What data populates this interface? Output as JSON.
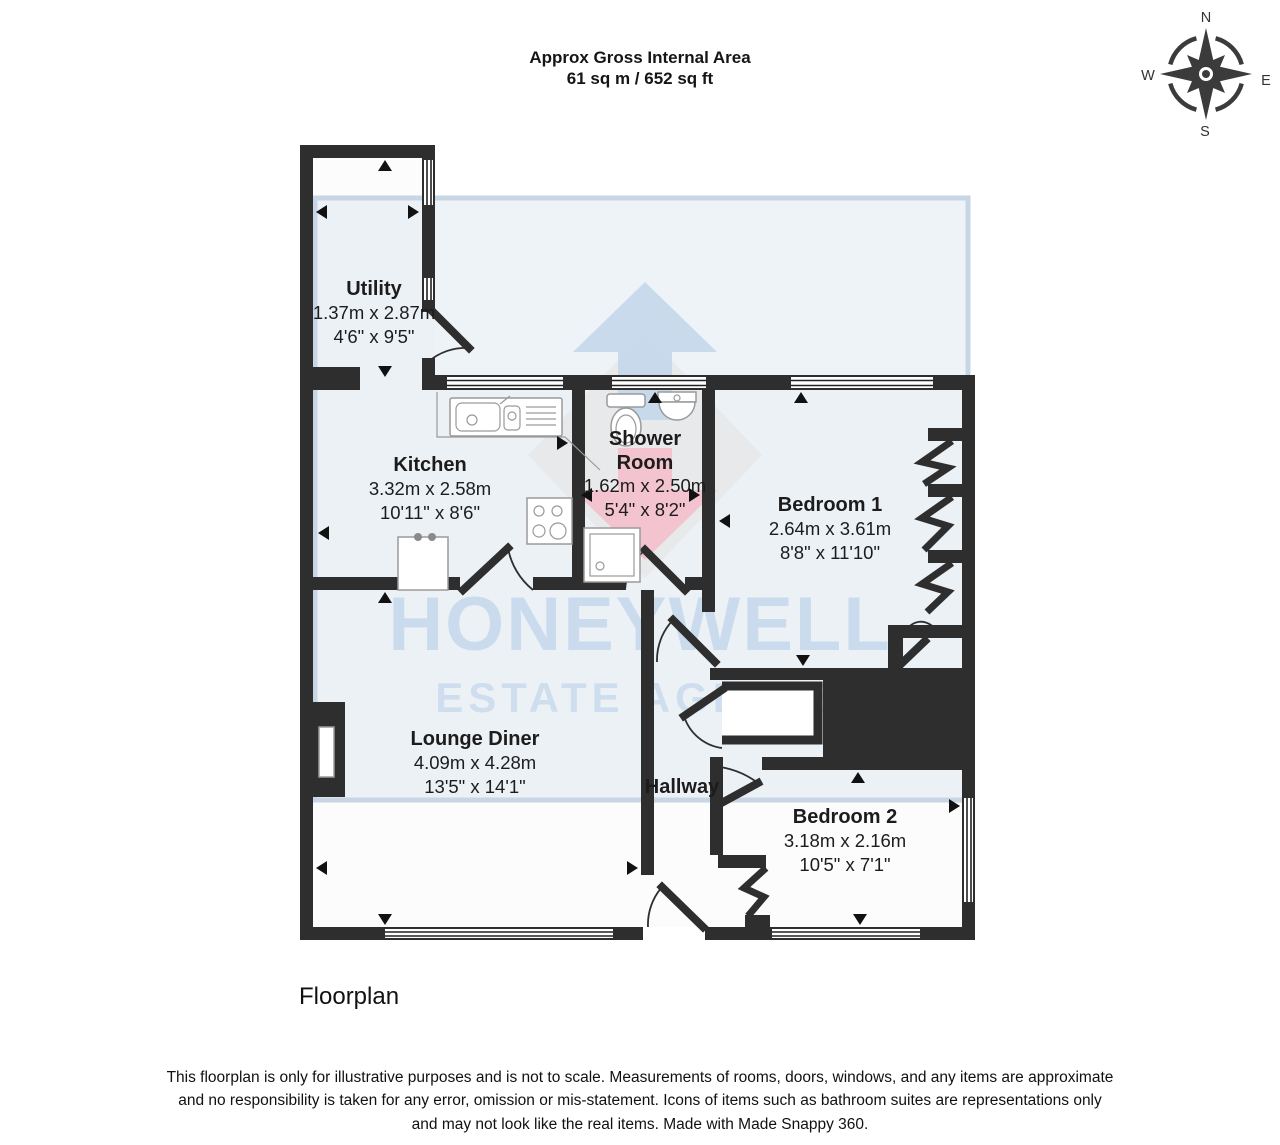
{
  "header": {
    "title": "Approx Gross Internal Area",
    "area": "61 sq m / 652 sq ft"
  },
  "compass": {
    "north": "N",
    "east": "E",
    "south": "S",
    "west": "W"
  },
  "rooms": {
    "utility": {
      "name": "Utility",
      "metric": "1.37m x 2.87m",
      "imperial": "4'6\" x 9'5\""
    },
    "kitchen": {
      "name": "Kitchen",
      "metric": "3.32m x 2.58m",
      "imperial": "10'11\" x 8'6\""
    },
    "shower_room": {
      "name": "Shower Room",
      "name_line1": "Shower",
      "name_line2": "Room",
      "metric": "1.62m x 2.50m",
      "imperial": "5'4\" x 8'2\""
    },
    "bedroom1": {
      "name": "Bedroom 1",
      "metric": "2.64m x 3.61m",
      "imperial": "8'8\" x 11'10\""
    },
    "lounge_diner": {
      "name": "Lounge Diner",
      "metric": "4.09m x 4.28m",
      "imperial": "13'5\" x 14'1\""
    },
    "hallway": {
      "name": "Hallway"
    },
    "bedroom2": {
      "name": "Bedroom 2",
      "metric": "3.18m x 2.16m",
      "imperial": "10'5\" x 7'1\""
    }
  },
  "watermark": {
    "line1": "HONEYWELL",
    "line2": "ESTATE AGENTS"
  },
  "caption": "Floorplan",
  "disclaimer": "This floorplan is only for illustrative purposes and is not to scale. Measurements of rooms, doors, windows, and any items are approximate and no responsibility is taken for any error, omission or mis-statement. Icons of items such as bathroom suites are representations only and may not look like the real items. Made with Made Snappy 360.",
  "colors": {
    "wall": "#2e2e2e",
    "overlay_fill": "#dbe4ef",
    "overlay_border": "#c8d5e5",
    "watermark_text": "#cbdbee",
    "logo_blue": "#c6d8ec",
    "logo_pink": "#f3c2cf",
    "logo_gray": "#e7e7e7"
  }
}
